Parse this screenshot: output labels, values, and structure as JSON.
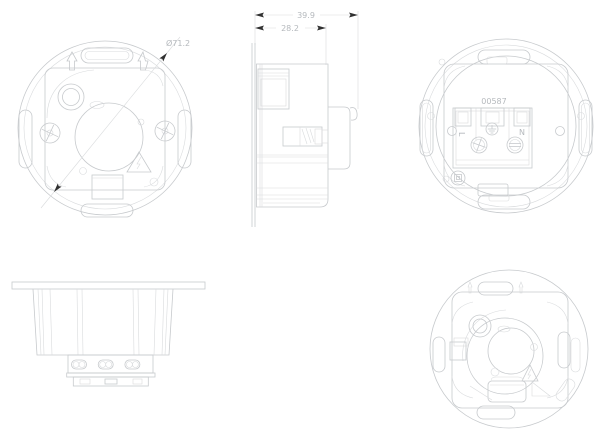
{
  "colors": {
    "bg": "#ffffff",
    "line": "#c7cacd",
    "faint": "#d9dbdd",
    "dark": "#303030",
    "text": "#b5b9bd"
  },
  "views": {
    "front_top_left": {
      "diameter_dim": "Ø71.2"
    },
    "side_top_middle": {
      "overall_depth_dim": "39.9",
      "body_depth_dim": "28.2"
    },
    "rear_top_right": {
      "part_number": "00587",
      "terminal_live": "L",
      "terminal_neutral": "N"
    }
  },
  "icons": {
    "warning": "high-voltage-warning-triangle",
    "earth": "earth-ground-symbol",
    "insulation": "double-insulation-symbol",
    "screw_left": "phillips-screw",
    "screw_right": "slotted-screw",
    "orientation": "up-arrow"
  }
}
